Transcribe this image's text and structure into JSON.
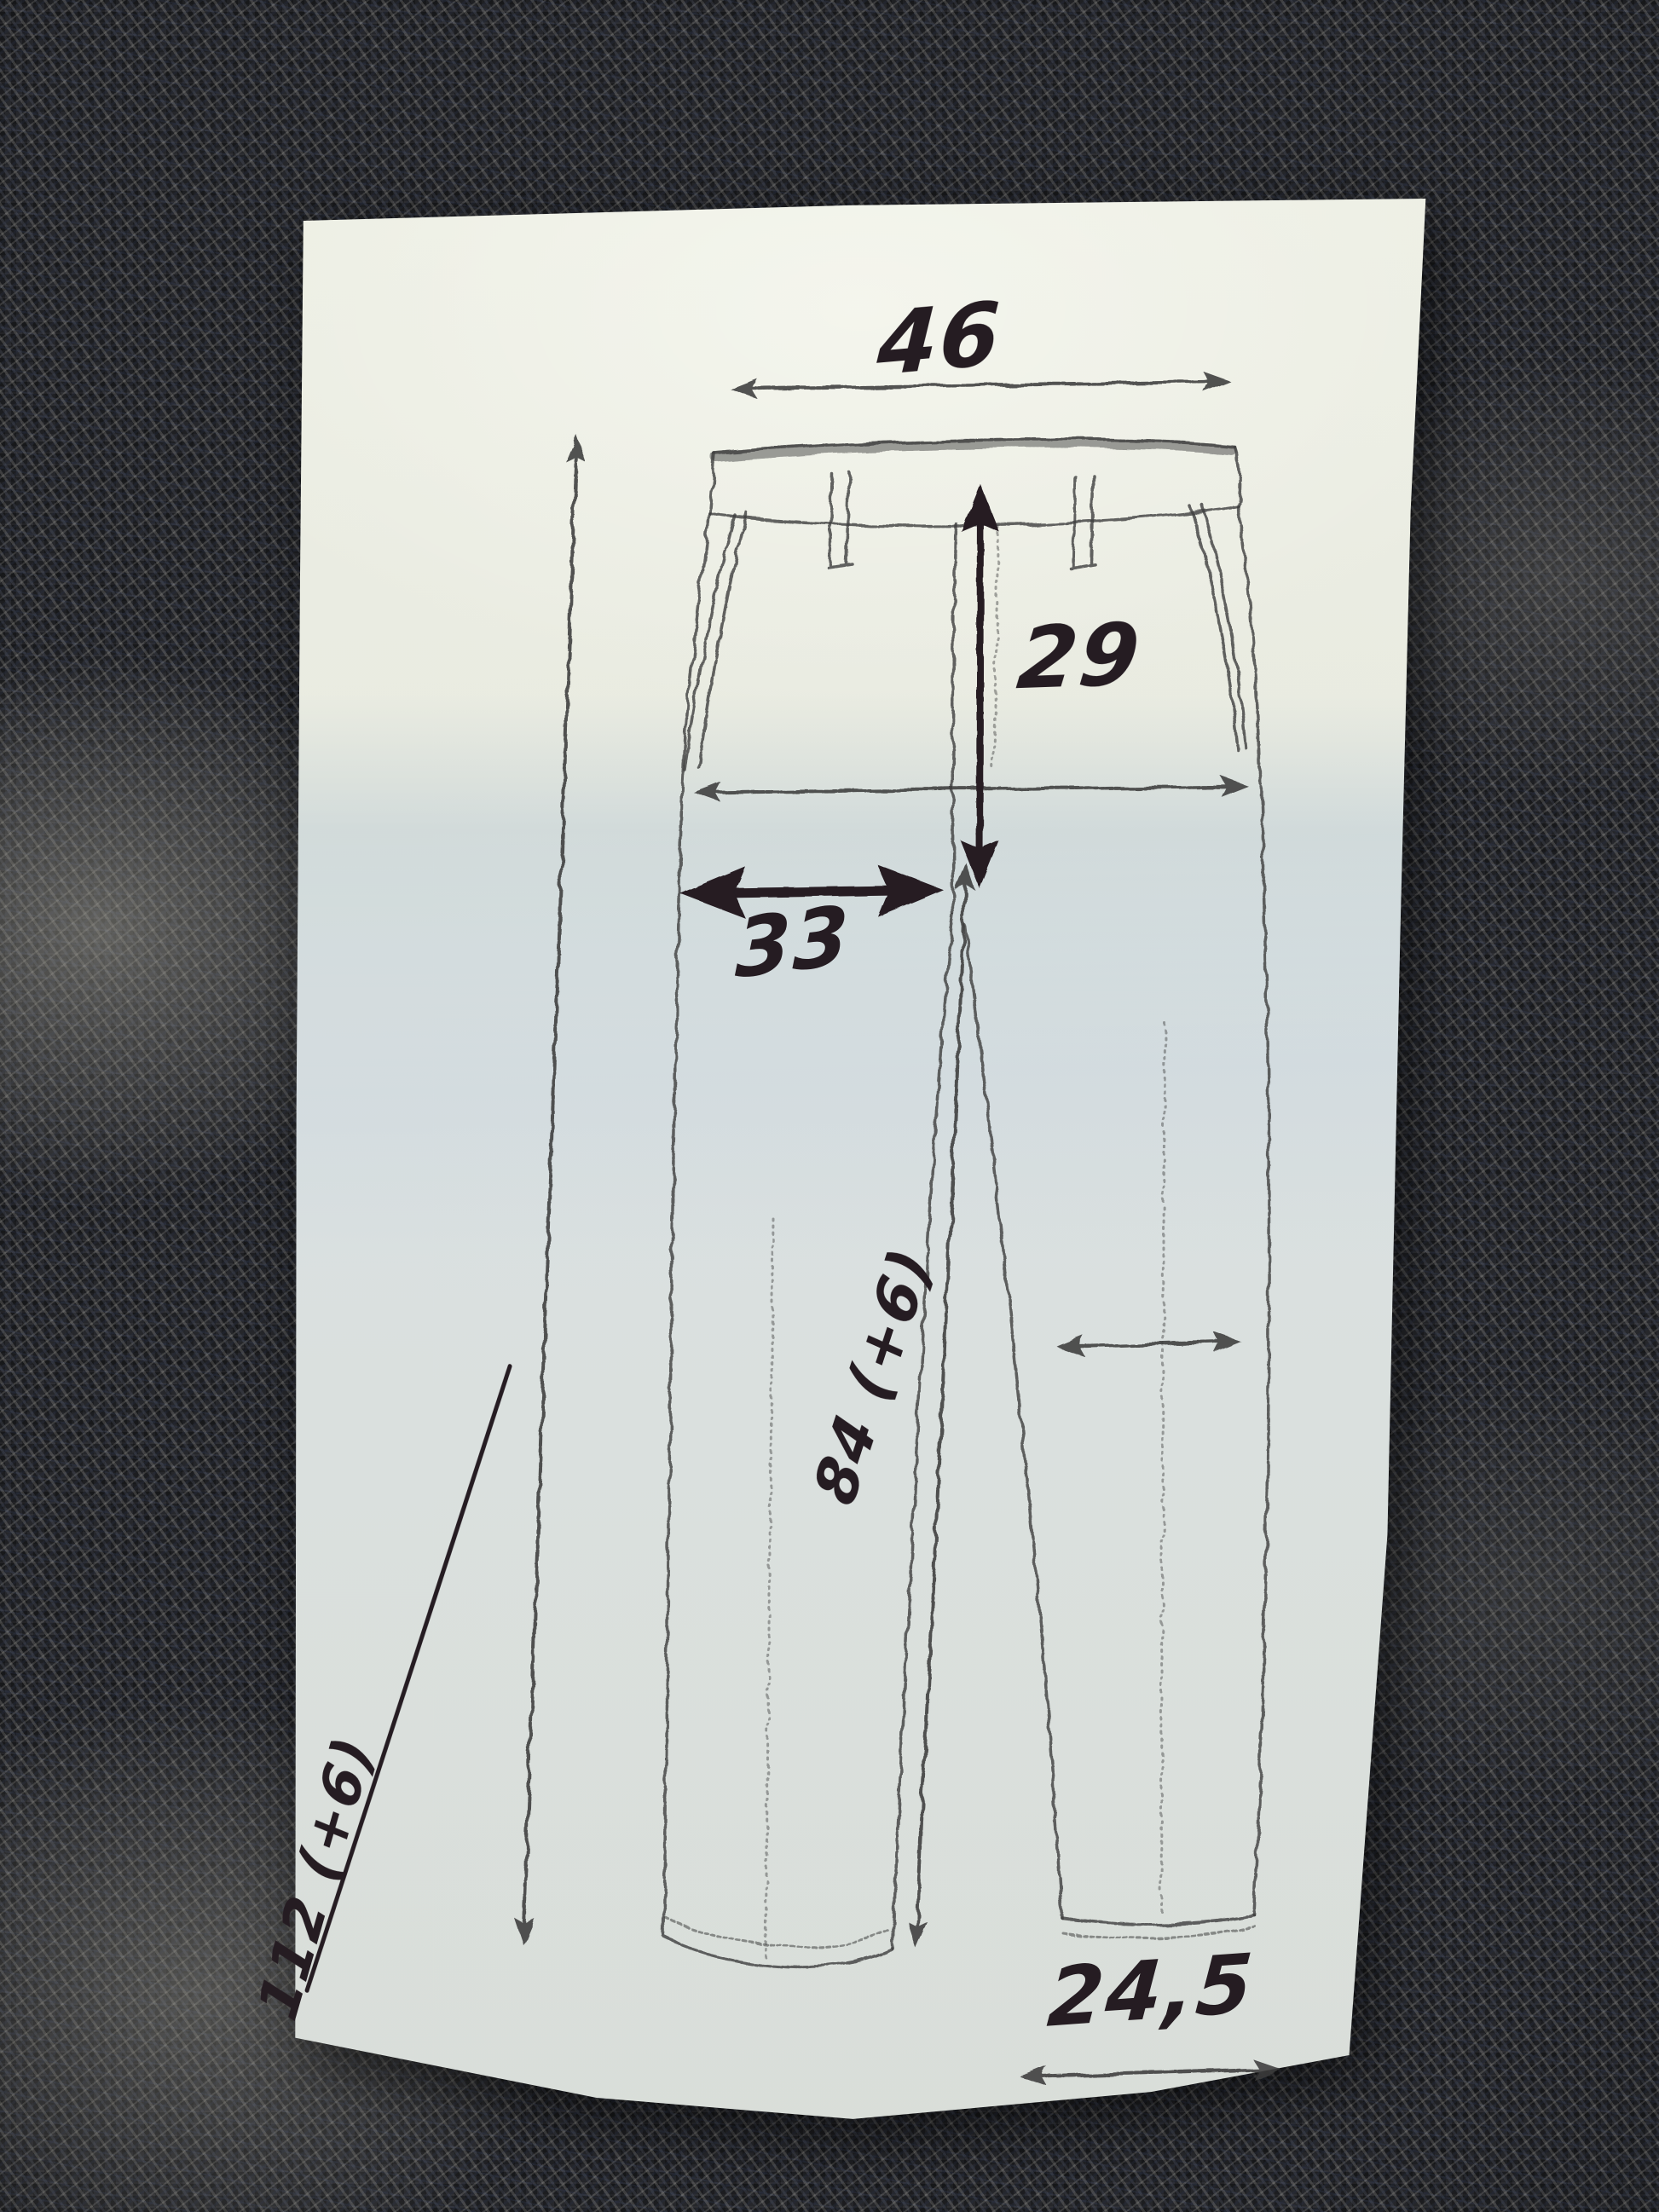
{
  "scene": {
    "description": "Hand-drawn trouser measurement sketch in ink and pencil on an off-white paper sheet lying on dark grey knitted fabric"
  },
  "measurements": {
    "waist": "46",
    "rise": "29",
    "thigh": "33",
    "outseam": "112 (+6)",
    "inseam": "84 (+6)",
    "hem": "24,5"
  },
  "colors": {
    "ink": "#251c22",
    "pencil": "#3f3f3f",
    "paper": "#e9eadf",
    "paper_shadow_tint": "#d9e0e4",
    "fabric_base": "#26272b"
  }
}
